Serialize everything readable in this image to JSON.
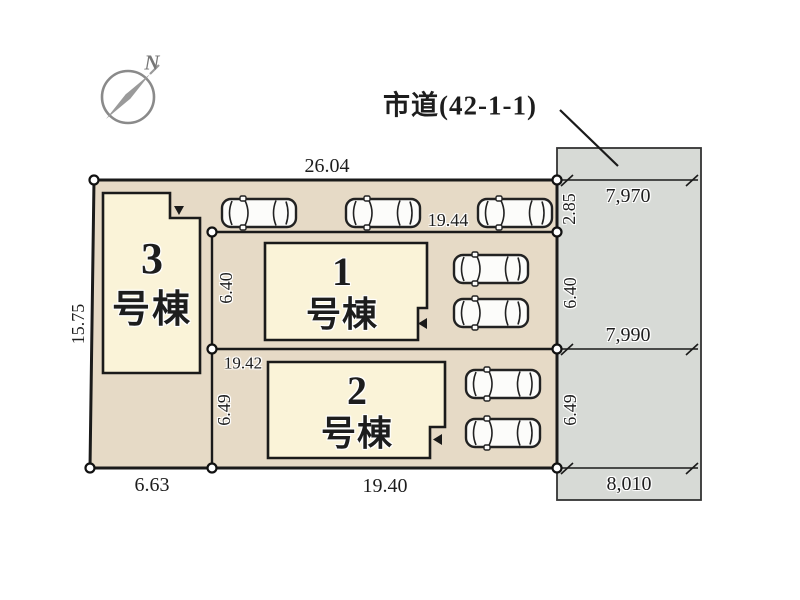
{
  "road_label": "市道(42-1-1)",
  "compass": {
    "north_label": "N"
  },
  "buildings": {
    "b3": {
      "number": "3",
      "suffix": "号棟"
    },
    "b1": {
      "number": "1",
      "suffix": "号棟"
    },
    "b2": {
      "number": "2",
      "suffix": "号棟"
    }
  },
  "plot_dimensions": {
    "top_width": "26.04",
    "left_height": "15.75",
    "bottom_left_width": "6.63",
    "bottom_width": "19.40",
    "lot1_top_width": "19.44",
    "lot1_left_height": "6.40",
    "lot2_top_width": "19.42",
    "lot2_left_height": "6.49",
    "right_top_height": "2.85",
    "right_mid_height": "6.40",
    "right_bottom_height": "6.49"
  },
  "road_dimensions": {
    "top_width": "7,970",
    "mid_width": "7,990",
    "bottom_width": "8,010"
  },
  "colors": {
    "plot_fill": "#e6dac6",
    "building_fill": "#faf3d8",
    "road_fill": "#d7dad6",
    "outline": "#1a1a1a"
  },
  "icons": {
    "car": "car-top-view-icon",
    "car_count": 7,
    "compass": "compass-north-icon"
  }
}
